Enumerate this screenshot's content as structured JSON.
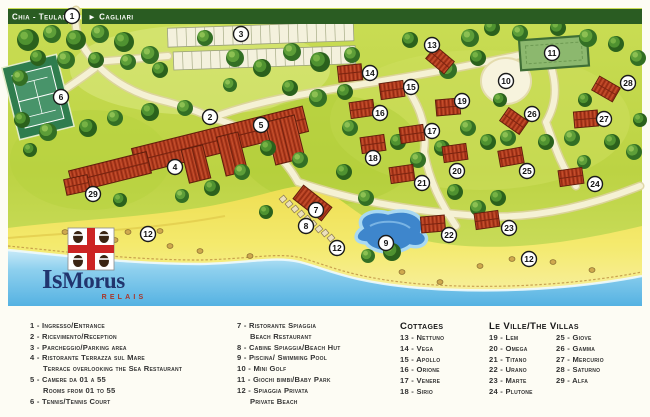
{
  "signbar": {
    "left": "Chia - Teulada ◄",
    "right": "► Cagliari"
  },
  "logo": {
    "title_a": "Is",
    "title_b": "Morus",
    "subtitle": "RELAIS"
  },
  "markers": [
    {
      "n": "1",
      "x": 72,
      "y": 16
    },
    {
      "n": "2",
      "x": 210,
      "y": 117
    },
    {
      "n": "3",
      "x": 241,
      "y": 34
    },
    {
      "n": "4",
      "x": 175,
      "y": 167
    },
    {
      "n": "5",
      "x": 261,
      "y": 125
    },
    {
      "n": "6",
      "x": 61,
      "y": 97
    },
    {
      "n": "7",
      "x": 316,
      "y": 210
    },
    {
      "n": "8",
      "x": 306,
      "y": 226
    },
    {
      "n": "9",
      "x": 386,
      "y": 243
    },
    {
      "n": "10",
      "x": 506,
      "y": 81
    },
    {
      "n": "11",
      "x": 552,
      "y": 53
    },
    {
      "n": "12",
      "x": 148,
      "y": 234
    },
    {
      "n": "12",
      "x": 337,
      "y": 248
    },
    {
      "n": "12",
      "x": 529,
      "y": 259
    },
    {
      "n": "13",
      "x": 432,
      "y": 45,
      "b": [
        8,
        15,
        40
      ]
    },
    {
      "n": "14",
      "x": 370,
      "y": 73,
      "b": [
        -20,
        0,
        -6
      ]
    },
    {
      "n": "15",
      "x": 411,
      "y": 87,
      "b": [
        -19,
        3,
        -8
      ]
    },
    {
      "n": "16",
      "x": 380,
      "y": 113,
      "b": [
        -18,
        -4,
        -8
      ]
    },
    {
      "n": "17",
      "x": 432,
      "y": 131,
      "b": [
        -20,
        3,
        -8
      ]
    },
    {
      "n": "18",
      "x": 373,
      "y": 158,
      "b": [
        0,
        -14,
        -8
      ]
    },
    {
      "n": "19",
      "x": 462,
      "y": 101,
      "b": [
        -14,
        6,
        -5
      ]
    },
    {
      "n": "20",
      "x": 457,
      "y": 171,
      "b": [
        -2,
        -18,
        -8
      ]
    },
    {
      "n": "21",
      "x": 422,
      "y": 183,
      "b": [
        -20,
        -9,
        -8
      ]
    },
    {
      "n": "22",
      "x": 449,
      "y": 235,
      "b": [
        -16,
        -11,
        -5
      ]
    },
    {
      "n": "23",
      "x": 509,
      "y": 228,
      "b": [
        -22,
        -8,
        -8
      ]
    },
    {
      "n": "24",
      "x": 595,
      "y": 184,
      "b": [
        -24,
        -7,
        -8
      ]
    },
    {
      "n": "25",
      "x": 527,
      "y": 171,
      "b": [
        -16,
        -14,
        -10
      ]
    },
    {
      "n": "26",
      "x": 532,
      "y": 114,
      "b": [
        -18,
        7,
        35
      ]
    },
    {
      "n": "27",
      "x": 604,
      "y": 119,
      "b": [
        -18,
        0,
        -5
      ]
    },
    {
      "n": "28",
      "x": 628,
      "y": 83,
      "b": [
        -22,
        6,
        30
      ]
    },
    {
      "n": "29",
      "x": 93,
      "y": 194,
      "b": [
        -16,
        -9,
        -12
      ]
    }
  ],
  "legend": {
    "col1": [
      {
        "n": "1",
        "t": "Ingresso/Entrance"
      },
      {
        "n": "2",
        "t": "Ricevimento/Reception"
      },
      {
        "n": "3",
        "t": "Parcheggio/Parking area"
      },
      {
        "n": "4",
        "t": "Ristorante Terrazza sul Mare",
        "c": "Terrace overlooking the Sea Restaurant"
      },
      {
        "n": "5",
        "t": "Camere da 01 a 55",
        "c": "Rooms from 01 to 55"
      },
      {
        "n": "6",
        "t": "Tennis/Tennis Court"
      }
    ],
    "col2": [
      {
        "n": "7",
        "t": "Ristorante Spiaggia",
        "c": "Beach Restaurant"
      },
      {
        "n": "8",
        "t": "Cabine Spiaggia/Beach Hut"
      },
      {
        "n": "9",
        "t": "Piscina/ Swimming Pool"
      },
      {
        "n": "10",
        "t": "Mini Golf"
      },
      {
        "n": "11",
        "t": "Giochi bimbi/Baby Park"
      },
      {
        "n": "12",
        "t": "Spiaggia Privata",
        "c": "Private Beach"
      }
    ],
    "cottages": {
      "title": "Cottages",
      "items": [
        {
          "n": "13",
          "t": "Nettuno"
        },
        {
          "n": "14",
          "t": "Vega"
        },
        {
          "n": "15",
          "t": "Apollo"
        },
        {
          "n": "16",
          "t": "Orione"
        },
        {
          "n": "17",
          "t": "Venere"
        },
        {
          "n": "18",
          "t": "Sirio"
        }
      ]
    },
    "villas": {
      "title": "Le Ville/The Villas",
      "left": [
        {
          "n": "19",
          "t": "Lem"
        },
        {
          "n": "20",
          "t": "Omega"
        },
        {
          "n": "21",
          "t": "Titano"
        },
        {
          "n": "22",
          "t": "Urano"
        },
        {
          "n": "23",
          "t": "Marte"
        },
        {
          "n": "24",
          "t": "Plutone"
        }
      ],
      "right": [
        {
          "n": "25",
          "t": "Giove"
        },
        {
          "n": "26",
          "t": "Gamma"
        },
        {
          "n": "27",
          "t": "Mercurio"
        },
        {
          "n": "28",
          "t": "Saturno"
        },
        {
          "n": "29",
          "t": "Alfa"
        }
      ]
    }
  },
  "colors": {
    "sign_green": "#2a5c22",
    "roof_red": "#b13a1d",
    "sea_blue": "#64bbe6",
    "sand_yellow": "#f2e75e",
    "grass_green": "#c2d84a",
    "pool_blue": "#3e86cc",
    "logo_navy": "#21356e",
    "logo_red": "#a8362a"
  }
}
